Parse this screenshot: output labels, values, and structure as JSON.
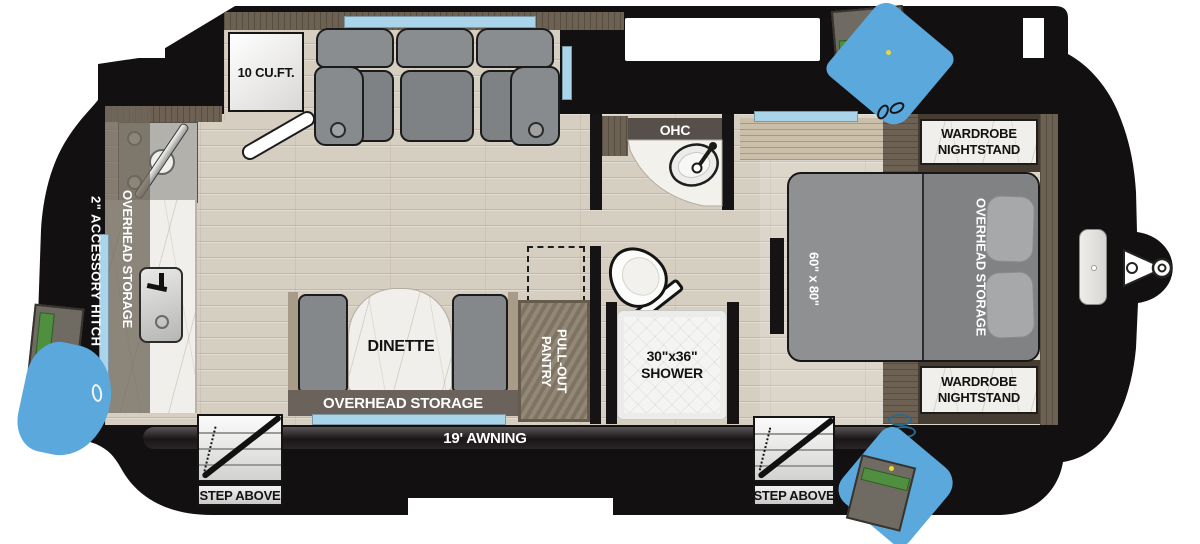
{
  "title": "Travel trailer floor plan",
  "colors": {
    "body_silhouette": "#131011",
    "floor_wood": "#d6cec0",
    "window_blue": "#a9d4ea",
    "door_swing_blue": "#5ba8dc",
    "entry_step_green": "#4f8f3f",
    "marble_counter": "#f1efeb",
    "upholstery_gray": "#85888a",
    "cabinet_wood_dark": "#6d6153",
    "pantry_wood": "#8b7f6d",
    "accent_yellow": "#e9d83b"
  },
  "labels": {
    "fridge": "10 CU.FT.",
    "kitchen_overhead_storage": "OVERHEAD STORAGE",
    "accessory_hitch": "2\" ACCESSORY HITCH",
    "ohc": "OHC",
    "dinette": "DINETTE",
    "dinette_overhead_storage": "OVERHEAD STORAGE",
    "pullout_pantry": "PULL-OUT\nPANTRY",
    "shower": "30\"x36\"\nSHOWER",
    "bed_size": "60\" x 80\"",
    "bed_overhead_storage": "OVERHEAD STORAGE",
    "wardrobe_nightstand_top": "WARDROBE\nNIGHTSTAND",
    "wardrobe_nightstand_bottom": "WARDROBE\nNIGHTSTAND",
    "awning": "19' AWNING",
    "step_above_front": "STEP ABOVE",
    "step_above_rear": "STEP ABOVE"
  }
}
